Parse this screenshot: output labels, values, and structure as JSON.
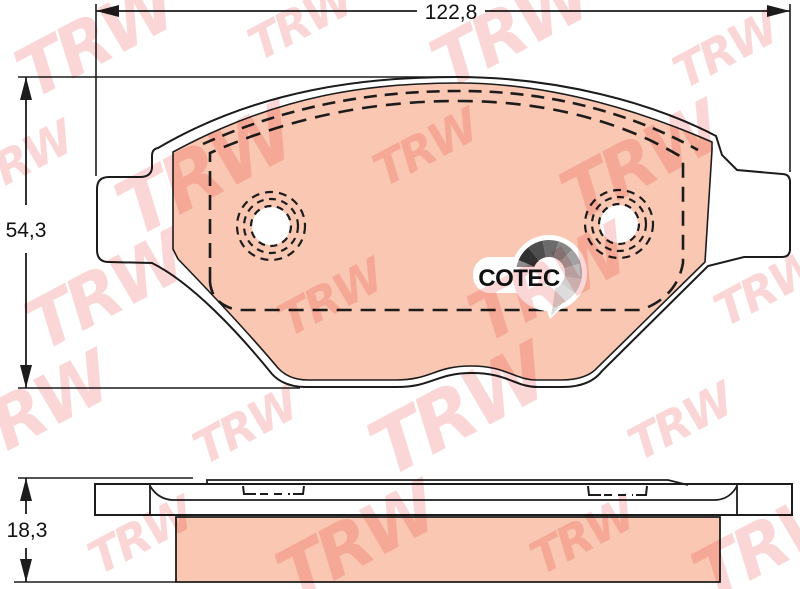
{
  "drawing": {
    "type": "brake-pad-technical-drawing",
    "dimensions": {
      "width": "122,8",
      "height": "54,3",
      "thickness": "18,3"
    },
    "logo": {
      "text": "COTEC",
      "fan_colors": [
        "#8e8e8e",
        "#313131",
        "#4e4e4e",
        "#6c6c6c",
        "#878787",
        "#a2a2a2",
        "#bcbcbc",
        "#cfcfcf",
        "#dcdcdc"
      ]
    },
    "watermark": {
      "text": "TRW",
      "color": "#f4a09c"
    },
    "colors": {
      "background": "#ffffff",
      "line": "#1c1c1c",
      "friction_material": "#f9c7b2"
    }
  }
}
